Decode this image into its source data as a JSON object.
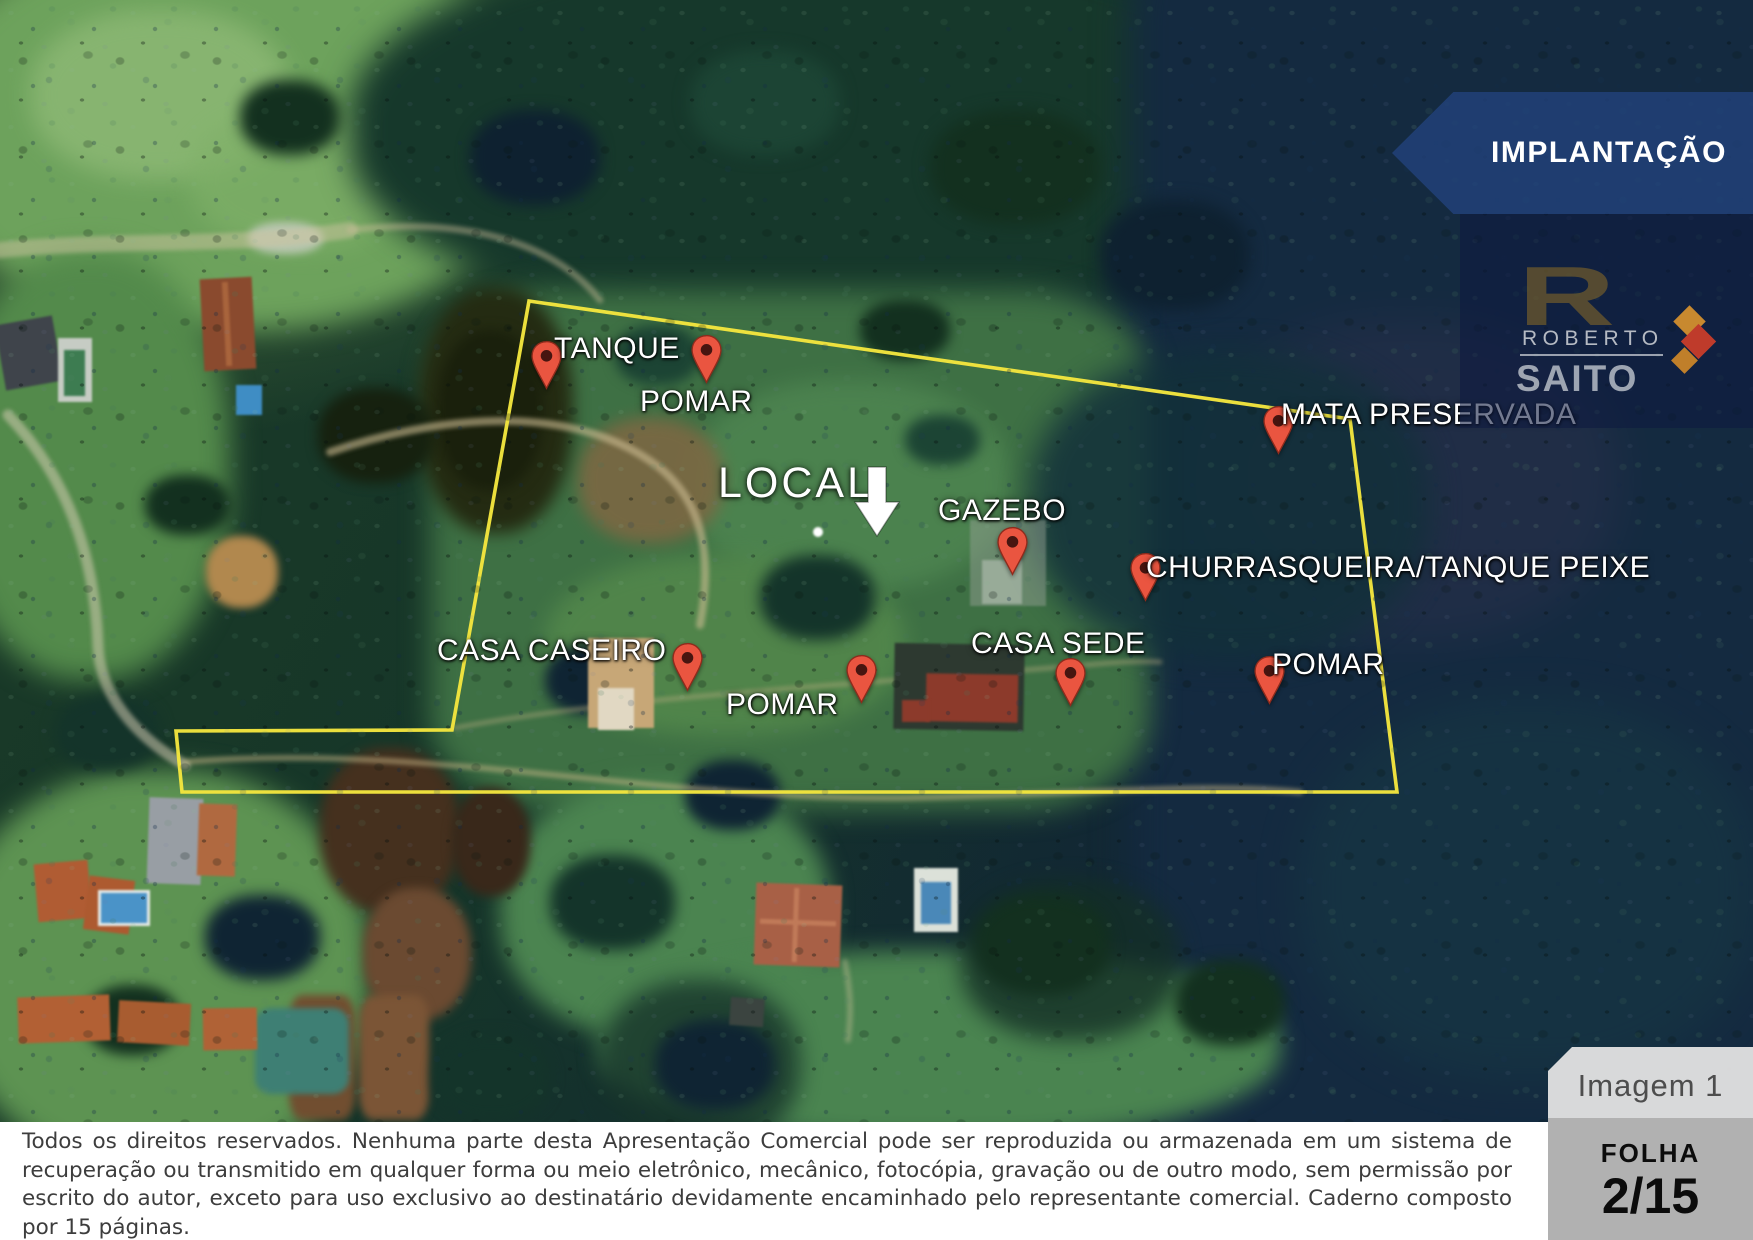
{
  "banner": {
    "title": "IMPLANTAÇÃO"
  },
  "logo": {
    "monogram": "R",
    "name_top": "ROBERTO",
    "name_bottom": "SAITO"
  },
  "map": {
    "local_label": "LOCAL",
    "markers": [
      {
        "id": "tanque",
        "label": "TANQUE"
      },
      {
        "id": "pomar-top",
        "label": "POMAR"
      },
      {
        "id": "mata-preservada",
        "label": "MATA PRESERVADA"
      },
      {
        "id": "gazebo",
        "label": "GAZEBO"
      },
      {
        "id": "churrasqueira",
        "label": "CHURRASQUEIRA/TANQUE PEIXE"
      },
      {
        "id": "casa-caseiro",
        "label": "CASA CASEIRO"
      },
      {
        "id": "pomar-center",
        "label": "POMAR"
      },
      {
        "id": "casa-sede",
        "label": "CASA SEDE"
      },
      {
        "id": "pomar-right",
        "label": "POMAR"
      }
    ]
  },
  "image_badge": {
    "label": "Imagem 1"
  },
  "sheet_badge": {
    "label": "FOLHA",
    "number": "2/15"
  },
  "footer": {
    "copyright": "Todos os direitos reservados. Nenhuma parte desta Apresentação Comercial pode ser reproduzida ou armazenada em um sistema de recuperação ou transmitido em qualquer forma ou meio eletrônico, mecânico, fotocópia, gravação ou de outro modo, sem permissão por escrito do autor, exceto para uso exclusivo ao destinatário devidamente encaminhado pelo representante comercial. Caderno composto por 15 páginas."
  },
  "colors": {
    "boundary": "#f3e53e",
    "pin": "#ea5540",
    "banner_bg": "#214279",
    "accent_gold": "#c8892f",
    "accent_red": "#bf3b2b"
  }
}
